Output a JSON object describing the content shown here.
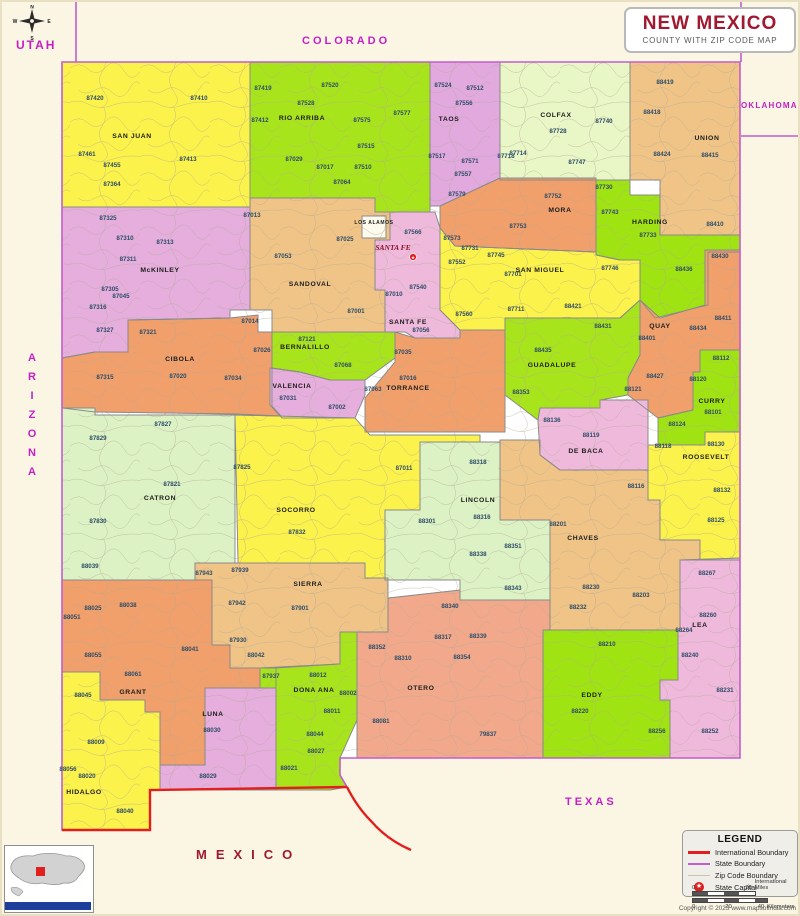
{
  "header": {
    "title": "NEW MEXICO",
    "subtitle": "COUNTY WITH ZIP CODE MAP"
  },
  "neighbors": {
    "utah": "UTAH",
    "colorado": "COLORADO",
    "oklahoma": "OKLAHOMA",
    "texas": "TEXAS",
    "arizona": "ARIZONA",
    "mexico": "MEXICO"
  },
  "compass": {
    "n": "N",
    "e": "E",
    "s": "S",
    "w": "W"
  },
  "legend": {
    "title": "LEGEND",
    "items": [
      {
        "label": "International Boundary",
        "type": "line",
        "color": "#e0201f",
        "weight": 3
      },
      {
        "label": "State Boundary",
        "type": "line",
        "color": "#c25ec9",
        "weight": 2
      },
      {
        "label": "Zip Code Boundary",
        "type": "line",
        "color": "#c9c2b2",
        "weight": 1
      },
      {
        "label": "State Capital",
        "type": "star",
        "color": "#e0201f"
      }
    ]
  },
  "scale": {
    "m0": "0",
    "m20": "20",
    "miles_unit": "International Miles",
    "k0": "0",
    "k20": "20",
    "k40": "40",
    "km_unit": "Kilometers"
  },
  "copyright": "Copyright © 2023 www.mapsofindia.com",
  "capital": {
    "name": "SANTA FE",
    "label_x": 393,
    "label_y": 250,
    "x": 413,
    "y": 257
  },
  "colors": {
    "state_line": "#c25ec9",
    "intl_line": "#e0201f",
    "county_border": "#8a8a8a",
    "zip_text": "#2e4d68",
    "county_text": "#1c1c1c",
    "base": "#ffffff",
    "zip_tex": "#b3a995"
  },
  "map": {
    "outline": "62,62 740,62 740,758 340,758 340,775 347,787 150,790 150,830 62,830",
    "state_lines": [
      {
        "x1": 76,
        "y1": 2,
        "x2": 76,
        "y2": 62
      },
      {
        "x1": 741,
        "y1": 2,
        "x2": 741,
        "y2": 62
      },
      {
        "x1": 741,
        "y1": 136,
        "x2": 798,
        "y2": 136
      }
    ],
    "intl_paths": [
      "M347,787 L150,790 L150,830 L62,830",
      "M347,787 C353,799 361,811 371,821 C383,835 397,844 411,850"
    ]
  },
  "counties": [
    {
      "name": "SAN JUAN",
      "color": "#FBF24B",
      "pts": "62,62 250,62 250,207 62,207",
      "lx": 132,
      "ly": 138,
      "zips": [
        [
          "87420",
          95,
          100
        ],
        [
          "87410",
          199,
          100
        ],
        [
          "87461",
          87,
          156
        ],
        [
          "87455",
          112,
          167
        ],
        [
          "87413",
          188,
          161
        ],
        [
          "87364",
          112,
          186
        ]
      ]
    },
    {
      "name": "RIO ARRIBA",
      "color": "#A8E41C",
      "pts": "250,62 430,62 430,212 375,212 375,198 250,198",
      "lx": 302,
      "ly": 120,
      "zips": [
        [
          "87419",
          263,
          90
        ],
        [
          "87520",
          330,
          87
        ],
        [
          "87528",
          306,
          105
        ],
        [
          "87412",
          260,
          122
        ],
        [
          "87575",
          362,
          122
        ],
        [
          "87577",
          402,
          115
        ],
        [
          "87515",
          366,
          148
        ],
        [
          "87029",
          294,
          161
        ],
        [
          "87017",
          325,
          169
        ],
        [
          "87510",
          363,
          169
        ],
        [
          "87064",
          342,
          184
        ]
      ]
    },
    {
      "name": "TAOS",
      "color": "#E2A9DE",
      "pts": "430,62 500,62 500,178 440,206 430,206",
      "lx": 449,
      "ly": 121,
      "zips": [
        [
          "87524",
          443,
          87
        ],
        [
          "87512",
          475,
          90
        ],
        [
          "87556",
          464,
          105
        ],
        [
          "87517",
          437,
          158
        ],
        [
          "87571",
          470,
          163
        ],
        [
          "87557",
          463,
          176
        ],
        [
          "87579",
          457,
          196
        ]
      ]
    },
    {
      "name": "COLFAX",
      "color": "#E9F6C6",
      "pts": "500,62 630,62 630,180 500,180",
      "lx": 556,
      "ly": 117,
      "zips": [
        [
          "87728",
          558,
          133
        ],
        [
          "87740",
          604,
          123
        ],
        [
          "87714",
          518,
          155
        ],
        [
          "87747",
          577,
          164
        ],
        [
          "87718",
          506,
          158
        ]
      ]
    },
    {
      "name": "UNION",
      "color": "#F0C487",
      "pts": "630,62 740,62 740,235 660,235 660,180 630,180",
      "lx": 707,
      "ly": 140,
      "zips": [
        [
          "88419",
          665,
          84
        ],
        [
          "88418",
          652,
          114
        ],
        [
          "88424",
          662,
          156
        ],
        [
          "88415",
          710,
          157
        ],
        [
          "88410",
          715,
          226
        ]
      ]
    },
    {
      "name": "MORA",
      "color": "#F1A06B",
      "pts": "440,206 500,178 596,178 596,252 455,246 440,228",
      "lx": 560,
      "ly": 212,
      "zips": [
        [
          "87752",
          553,
          198
        ],
        [
          "87753",
          518,
          228
        ]
      ]
    },
    {
      "name": "HARDING",
      "color": "#9FE312",
      "pts": "596,180 630,180 630,195 660,195 660,235 740,235 740,252 708,252 708,305 655,318 640,300 640,260 620,260 596,255",
      "lx": 650,
      "ly": 224,
      "zips": [
        [
          "87730",
          604,
          189
        ],
        [
          "87743",
          610,
          214
        ],
        [
          "87733",
          648,
          237
        ],
        [
          "88436",
          684,
          271
        ]
      ]
    },
    {
      "name": "McKINLEY",
      "color": "#E5AEDD",
      "pts": "62,207 250,207 250,310 230,310 230,318 128,320 128,352 95,352 62,358",
      "lx": 160,
      "ly": 272,
      "zips": [
        [
          "87325",
          108,
          220
        ],
        [
          "87310",
          125,
          240
        ],
        [
          "87313",
          165,
          244
        ],
        [
          "87311",
          128,
          261
        ],
        [
          "87305",
          110,
          291
        ],
        [
          "87045",
          121,
          298
        ],
        [
          "87316",
          98,
          309
        ],
        [
          "87327",
          105,
          332
        ]
      ]
    },
    {
      "name": "SANDOVAL",
      "color": "#F0C487",
      "pts": "250,198 375,198 375,212 390,212 390,240 375,240 375,290 385,290 385,332 272,332 272,310 250,310",
      "lx": 310,
      "ly": 286,
      "zips": [
        [
          "87013",
          252,
          217
        ],
        [
          "87053",
          283,
          258
        ],
        [
          "87025",
          345,
          241
        ],
        [
          "87001",
          356,
          313
        ]
      ]
    },
    {
      "name": "LOS ALAMOS",
      "color": "#FCFAEC",
      "pts": "362,216 386,216 386,238 362,238",
      "lx": 374,
      "ly": 224,
      "small": true,
      "zips": []
    },
    {
      "name": "SANTA FE",
      "color": "#EFB9DC",
      "pts": "390,212 435,212 440,228 440,310 460,330 460,338 415,338 405,332 385,332 385,290 375,290 375,240 390,240",
      "lx": 408,
      "ly": 324,
      "zips": [
        [
          "87566",
          413,
          234
        ],
        [
          "87540",
          418,
          289
        ],
        [
          "87010",
          394,
          296
        ],
        [
          "87056",
          421,
          332
        ]
      ]
    },
    {
      "name": "SAN MIGUEL",
      "color": "#FBF24B",
      "pts": "440,228 455,246 596,252 596,255 620,260 640,260 640,300 620,318 505,318 505,330 460,330 440,310",
      "lx": 540,
      "ly": 272,
      "zips": [
        [
          "87573",
          452,
          240
        ],
        [
          "87731",
          470,
          250
        ],
        [
          "87552",
          457,
          264
        ],
        [
          "87745",
          496,
          257
        ],
        [
          "87701",
          513,
          276
        ],
        [
          "87746",
          610,
          270
        ],
        [
          "87560",
          464,
          316
        ],
        [
          "87711",
          516,
          311
        ],
        [
          "88421",
          573,
          308
        ]
      ]
    },
    {
      "name": "QUAY",
      "color": "#F1A06B",
      "pts": "705,250 740,250 740,350 700,350 700,372 693,372 693,410 658,418 628,395 628,378 640,355 640,300 660,318 705,305",
      "lx": 660,
      "ly": 328,
      "zips": [
        [
          "88430",
          720,
          258
        ],
        [
          "88411",
          723,
          320
        ],
        [
          "88434",
          698,
          330
        ],
        [
          "88401",
          647,
          340
        ],
        [
          "88427",
          655,
          378
        ],
        [
          "88121",
          633,
          391
        ]
      ]
    },
    {
      "name": "GUADALUPE",
      "color": "#A8E41C",
      "pts": "505,318 620,318 640,300 640,355 628,378 628,395 600,400 600,408 540,408 538,420 505,395",
      "lx": 552,
      "ly": 367,
      "zips": [
        [
          "88435",
          543,
          352
        ],
        [
          "88431",
          603,
          328
        ],
        [
          "88353",
          521,
          394
        ]
      ]
    },
    {
      "name": "CIBOLA",
      "color": "#F1A06B",
      "pts": "62,358 95,352 128,352 128,320 230,318 258,315 258,332 272,332 272,406 281,416 235,414 95,412 62,408",
      "lx": 180,
      "ly": 361,
      "zips": [
        [
          "87321",
          148,
          334
        ],
        [
          "87014",
          250,
          323
        ],
        [
          "87026",
          262,
          352
        ],
        [
          "87315",
          105,
          379
        ],
        [
          "87020",
          178,
          378
        ],
        [
          "87034",
          233,
          380
        ]
      ]
    },
    {
      "name": "BERNALILLO",
      "color": "#A8E41C",
      "pts": "272,332 395,332 395,358 365,380 330,380 300,372 272,368",
      "lx": 305,
      "ly": 349,
      "zips": [
        [
          "87121",
          307,
          341
        ],
        [
          "87068",
          343,
          367
        ]
      ]
    },
    {
      "name": "VALENCIA",
      "color": "#E5AEDD",
      "pts": "270,368 300,372 330,380 365,380 365,395 355,418 282,418 270,405",
      "lx": 292,
      "ly": 388,
      "zips": [
        [
          "87031",
          288,
          400
        ],
        [
          "87002",
          337,
          409
        ]
      ]
    },
    {
      "name": "TORRANCE",
      "color": "#F1A06B",
      "pts": "395,332 415,338 460,338 460,330 505,330 505,432 365,432 365,398 395,362",
      "lx": 408,
      "ly": 390,
      "zips": [
        [
          "87035",
          403,
          354
        ],
        [
          "87016",
          408,
          380
        ],
        [
          "87063",
          373,
          391
        ]
      ]
    },
    {
      "name": "DE BACA",
      "color": "#EFB9DC",
      "pts": "538,420 540,408 600,408 600,400 648,400 648,470 560,470 540,455",
      "lx": 586,
      "ly": 453,
      "zips": [
        [
          "88136",
          552,
          422
        ],
        [
          "88119",
          591,
          437
        ]
      ]
    },
    {
      "name": "CURRY",
      "color": "#9FE312",
      "pts": "700,350 740,350 740,432 705,432 705,445 658,445 658,418 693,410 693,372 700,372",
      "lx": 712,
      "ly": 403,
      "zips": [
        [
          "88112",
          721,
          360
        ],
        [
          "88120",
          698,
          381
        ],
        [
          "88101",
          713,
          414
        ],
        [
          "88124",
          677,
          426
        ]
      ]
    },
    {
      "name": "ROOSEVELT",
      "color": "#FBF24B",
      "pts": "648,445 705,445 705,432 740,432 740,560 700,560 700,540 660,540 660,500 648,500",
      "lx": 706,
      "ly": 459,
      "zips": [
        [
          "88118",
          663,
          448
        ],
        [
          "88130",
          716,
          446
        ],
        [
          "88132",
          722,
          492
        ],
        [
          "88125",
          716,
          522
        ]
      ]
    },
    {
      "name": "CATRON",
      "color": "#DCF2C4",
      "pts": "62,408 95,408 95,415 235,415 235,563 195,563 195,580 62,580",
      "lx": 160,
      "ly": 500,
      "zips": [
        [
          "87829",
          98,
          440
        ],
        [
          "87827",
          163,
          426
        ],
        [
          "87821",
          172,
          486
        ],
        [
          "87830",
          98,
          523
        ],
        [
          "88039",
          90,
          568
        ]
      ]
    },
    {
      "name": "SOCORRO",
      "color": "#FBF24B",
      "pts": "235,415 355,418 370,435 480,435 480,442 420,442 420,510 385,510 385,578 365,578 365,563 238,563",
      "lx": 296,
      "ly": 512,
      "zips": [
        [
          "87825",
          242,
          469
        ],
        [
          "87832",
          297,
          534
        ],
        [
          "87011",
          404,
          470
        ]
      ]
    },
    {
      "name": "LINCOLN",
      "color": "#DCF2C4",
      "pts": "420,442 500,442 500,520 550,520 550,600 460,600 460,580 385,580 385,510 420,510",
      "lx": 478,
      "ly": 502,
      "zips": [
        [
          "88318",
          478,
          464
        ],
        [
          "88316",
          482,
          519
        ],
        [
          "88301",
          427,
          523
        ],
        [
          "88351",
          513,
          548
        ],
        [
          "88338",
          478,
          556
        ],
        [
          "88343",
          513,
          590
        ]
      ]
    },
    {
      "name": "CHAVES",
      "color": "#F0C487",
      "pts": "500,440 540,440 540,455 560,470 648,470 648,500 660,500 660,540 700,540 700,560 680,560 680,630 550,630 550,520 500,520",
      "lx": 583,
      "ly": 540,
      "zips": [
        [
          "88116",
          636,
          488
        ],
        [
          "88201",
          558,
          526
        ],
        [
          "88230",
          591,
          589
        ],
        [
          "88203",
          641,
          597
        ],
        [
          "88232",
          578,
          609
        ]
      ]
    },
    {
      "name": "SIERRA",
      "color": "#F0C487",
      "pts": "195,563 365,563 365,578 388,578 388,632 340,632 340,664 276,668 230,668 230,645 212,645 212,580 195,580",
      "lx": 308,
      "ly": 586,
      "zips": [
        [
          "87939",
          240,
          572
        ],
        [
          "87943",
          204,
          575
        ],
        [
          "87942",
          237,
          605
        ],
        [
          "87901",
          300,
          610
        ],
        [
          "87930",
          238,
          642
        ],
        [
          "88042",
          256,
          657
        ]
      ]
    },
    {
      "name": "GRANT",
      "color": "#F1A06B",
      "pts": "62,580 212,580 212,645 230,645 230,668 276,668 276,688 205,688 205,765 160,765 160,712 145,712 145,700 100,700 100,672 62,672",
      "lx": 133,
      "ly": 694,
      "zips": [
        [
          "88025",
          93,
          610
        ],
        [
          "88038",
          128,
          607
        ],
        [
          "88051",
          72,
          619
        ],
        [
          "88055",
          93,
          657
        ],
        [
          "88061",
          133,
          676
        ],
        [
          "88041",
          190,
          651
        ]
      ]
    },
    {
      "name": "HIDALGO",
      "color": "#FBF24B",
      "pts": "62,672 100,672 100,700 145,700 145,712 160,712 160,790 150,790 150,830 62,830",
      "lx": 84,
      "ly": 794,
      "zips": [
        [
          "88045",
          83,
          697
        ],
        [
          "88009",
          96,
          744
        ],
        [
          "88056",
          68,
          771
        ],
        [
          "88020",
          87,
          778
        ],
        [
          "88040",
          125,
          813
        ]
      ]
    },
    {
      "name": "LUNA",
      "color": "#E5AEDD",
      "pts": "205,688 276,688 276,790 160,790 160,765 205,765",
      "lx": 213,
      "ly": 716,
      "zips": [
        [
          "88030",
          212,
          732
        ],
        [
          "88029",
          208,
          778
        ]
      ]
    },
    {
      "name": "DONA ANA",
      "color": "#A8E41C",
      "pts": "260,668 340,664 340,632 357,632 357,720 340,758 340,775 347,787 330,790 276,790 276,688 260,688",
      "lx": 314,
      "ly": 692,
      "zips": [
        [
          "87937",
          271,
          678
        ],
        [
          "88012",
          318,
          677
        ],
        [
          "88002",
          348,
          695
        ],
        [
          "88011",
          332,
          713
        ],
        [
          "88044",
          315,
          736
        ],
        [
          "88027",
          316,
          753
        ],
        [
          "88021",
          289,
          770
        ]
      ]
    },
    {
      "name": "OTERO",
      "color": "#F2A98B",
      "pts": "357,632 388,632 388,598 460,590 460,600 550,600 550,630 543,630 543,758 357,758",
      "lx": 421,
      "ly": 690,
      "zips": [
        [
          "88340",
          450,
          608
        ],
        [
          "88352",
          377,
          649
        ],
        [
          "88317",
          443,
          639
        ],
        [
          "88310",
          403,
          660
        ],
        [
          "88354",
          462,
          659
        ],
        [
          "88339",
          478,
          638
        ],
        [
          "88081",
          381,
          723
        ],
        [
          "79837",
          488,
          736
        ]
      ]
    },
    {
      "name": "EDDY",
      "color": "#9FE312",
      "pts": "543,630 678,630 678,680 660,680 660,700 670,700 670,758 543,758",
      "lx": 592,
      "ly": 697,
      "zips": [
        [
          "88210",
          607,
          646
        ],
        [
          "88220",
          580,
          713
        ],
        [
          "88256",
          657,
          733
        ]
      ]
    },
    {
      "name": "LEA",
      "color": "#EFB9DC",
      "pts": "680,560 740,558 740,758 670,758 670,700 660,700 660,680 678,680 678,630 680,630",
      "lx": 700,
      "ly": 627,
      "zips": [
        [
          "88267",
          707,
          575
        ],
        [
          "88260",
          708,
          617
        ],
        [
          "88264",
          684,
          632
        ],
        [
          "88240",
          690,
          657
        ],
        [
          "88231",
          725,
          692
        ],
        [
          "88252",
          710,
          733
        ]
      ]
    }
  ]
}
